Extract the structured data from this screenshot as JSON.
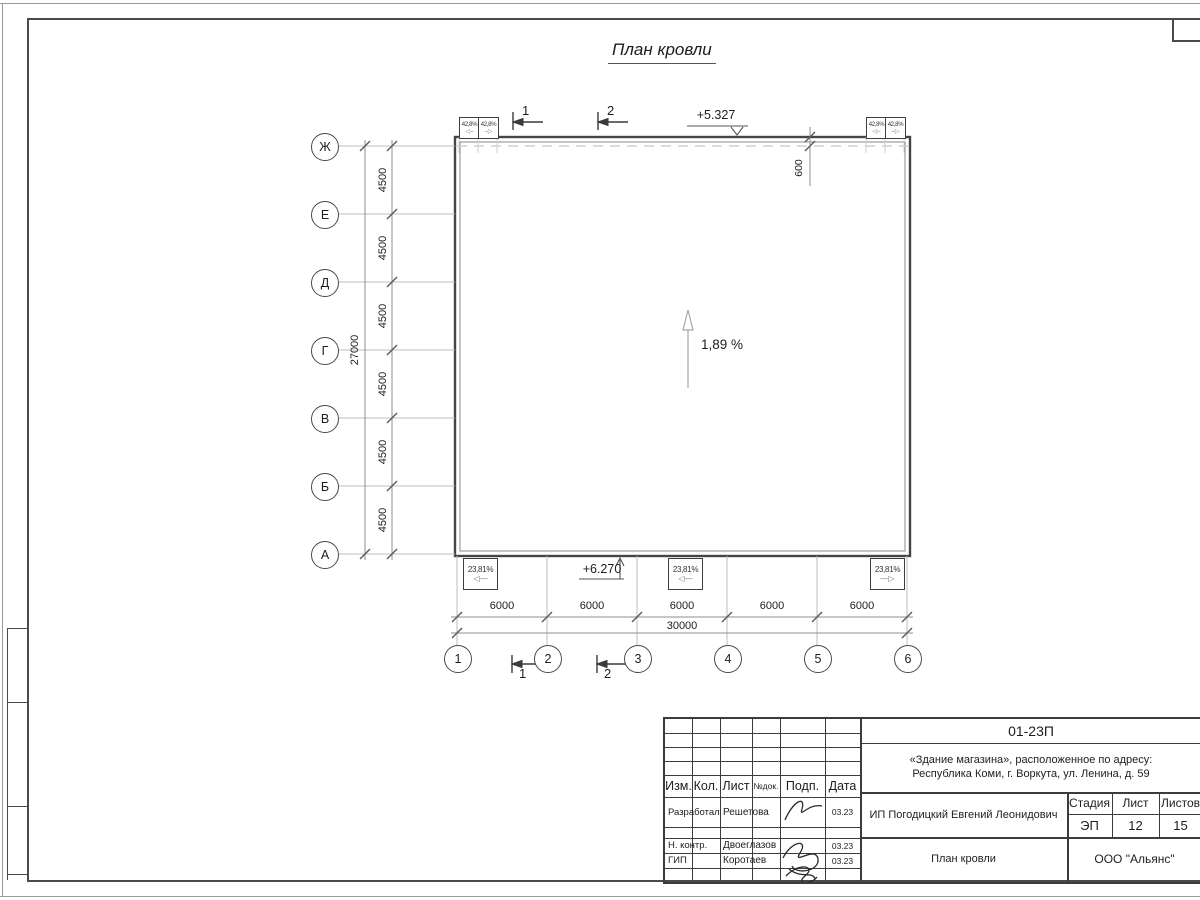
{
  "drawing": {
    "title": "План кровли",
    "slope_label": "1,89 %",
    "elevation_top": "+5.327",
    "elevation_bottom": "+6.270",
    "parapet_offset": "600",
    "row_axes": [
      "Ж",
      "Е",
      "Д",
      "Г",
      "В",
      "Б",
      "А"
    ],
    "col_axes": [
      "1",
      "2",
      "3",
      "4",
      "5",
      "6"
    ],
    "row_spacing": [
      "4500",
      "4500",
      "4500",
      "4500",
      "4500",
      "4500"
    ],
    "row_total": "27000",
    "col_spacing": [
      "6000",
      "6000",
      "6000",
      "6000",
      "6000"
    ],
    "col_total": "30000",
    "top_funnel_labels": [
      "42,8%",
      "42,8%",
      "42,8%",
      "42,8%"
    ],
    "bottom_funnel_labels": [
      "23,81%",
      "23,81%",
      "23,81%"
    ],
    "section_marks_top": [
      "1",
      "2"
    ],
    "section_marks_bottom": [
      "1",
      "2"
    ]
  },
  "titleblock": {
    "doc_number": "01-23П",
    "object_address_line1": "«Здание магазина», расположенное по адресу:",
    "object_address_line2": "Республика Коми, г. Воркута, ул. Ленина, д. 59",
    "client": "ИП Погодицкий Евгений Леонидович",
    "drawing_name": "План кровли",
    "organization": "ООО \"Альянс\"",
    "stage_label": "Стадия",
    "sheet_label": "Лист",
    "sheets_label": "Листов",
    "stage_value": "ЭП",
    "sheet_value": "12",
    "sheets_value": "15",
    "columns": {
      "izm": "Изм.",
      "kol": "Кол.",
      "list": "Лист",
      "doc": "№док.",
      "sign": "Подп.",
      "date": "Дата"
    },
    "signature_rows": [
      {
        "role": "Разработал",
        "name": "Решетова",
        "date": "03.23"
      },
      {
        "role": "Н. контр.",
        "name": "Двоеглазов",
        "date": "03.23"
      },
      {
        "role": "ГИП",
        "name": "Коротаев",
        "date": "03.23"
      }
    ]
  },
  "colors": {
    "line_dark": "#3c3c3c",
    "line_gray": "#bdbdbd",
    "accent_none": "#ffffff"
  }
}
